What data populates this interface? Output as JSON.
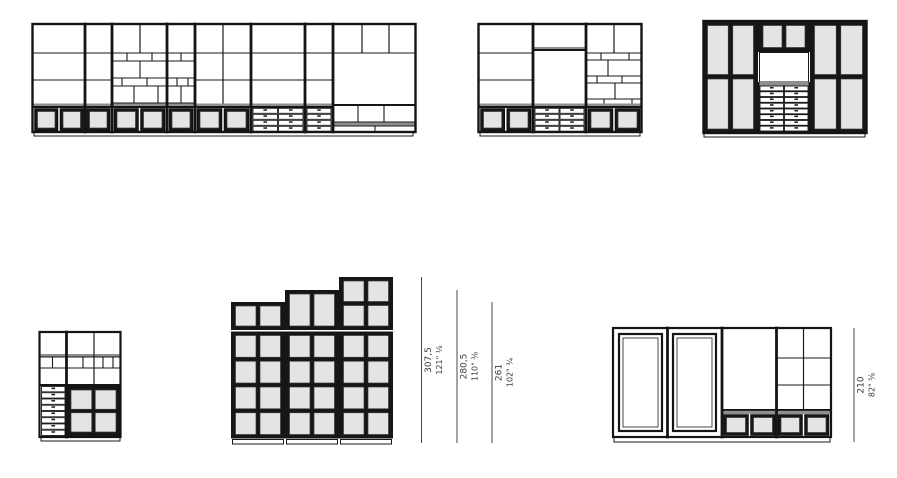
{
  "canvas": {
    "width": 897,
    "height": 478,
    "background": "#ffffff"
  },
  "colors": {
    "line": "#1a1a1a",
    "dark_frame": "#161616",
    "glass": "#e4e4e4",
    "shade": "#8f8f8f",
    "dimension_line": "#4a4a4a",
    "dimension_text": "#3a3a3a"
  },
  "dimensions": [
    {
      "cm": "307,5",
      "inches": "121\" ⅛"
    },
    {
      "cm": "280,5",
      "inches": "110\" ⅜"
    },
    {
      "cm": "261",
      "inches": "102\" ¾"
    },
    {
      "cm": "210",
      "inches": "82\" ⅝"
    }
  ],
  "units": [
    {
      "id": "top-left-wall-system",
      "description": "eight-bay wall system: open shelving, mosaic niches, glass base doors, base drawers, bench bay"
    },
    {
      "id": "top-middle-wall-system",
      "description": "three-bay wall system: open shelving, drawer base, mosaic niche bay, glass base doors"
    },
    {
      "id": "top-right-glass-cabinet",
      "description": "tall glass-door cabinet with central open niche and drawer stack"
    },
    {
      "id": "bottom-left-cabinet",
      "description": "small cabinet: niche shelving over drawer column and glass display doors"
    },
    {
      "id": "bottom-middle-stepped-cabinet",
      "description": "stepped glass-pane cabinet in three heights"
    },
    {
      "id": "bottom-right-sideboard",
      "description": "sideboard: two framed doors, open bay with glass base, open shelf bay with glass base"
    }
  ]
}
